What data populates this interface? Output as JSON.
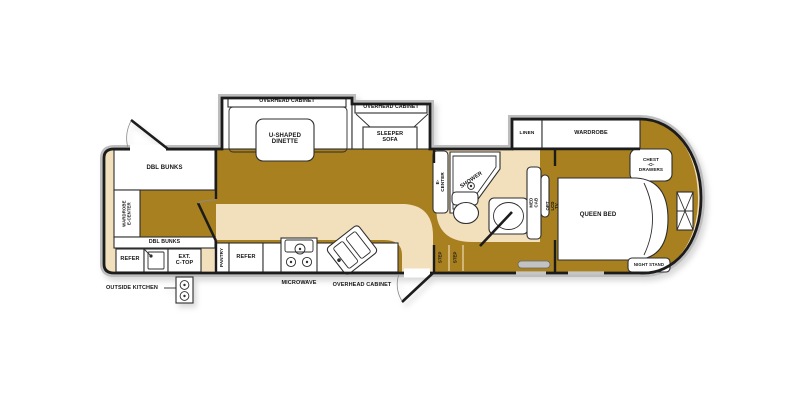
{
  "colors": {
    "floor_dark": "#a8801f",
    "floor_light": "#f2dfbb",
    "wall": "#1c1c1c",
    "hull": "#bdbdbd"
  },
  "labels": {
    "bunk_top": "DBL BUNKS",
    "bunk_wardrobe": "WARDROBE\nE-CENTER",
    "bunk_bottom": "DBL BUNKS",
    "ok_refer": "REFER",
    "ok_ctop": "EXT.\nC-TOP",
    "ok_caption": "OUTSIDE KITCHEN",
    "dinette_cabinet": "OVERHEAD CABINET",
    "dinette": "U-SHAPED\nDINETTE",
    "sofa_cabinet": "OVERHEAD CABINET",
    "sofa": "SLEEPER\nSOFA",
    "pantry": "PANTRY",
    "refer": "REFER",
    "microwave": "MICROWAVE",
    "kitchen_cabinet": "OVERHEAD CABINET",
    "ecenter": "E-CENTER",
    "shower": "SHOWER",
    "medcab": "MED CAB",
    "opt_tv": "OPT LCD TV",
    "step": "STEP",
    "linen": "LINEN",
    "wardrobe": "WARDROBE",
    "chest": "CHEST\n-O-\nDRAWERS",
    "queen": "QUEEN BED",
    "nightstand": "NIGHT STAND"
  }
}
